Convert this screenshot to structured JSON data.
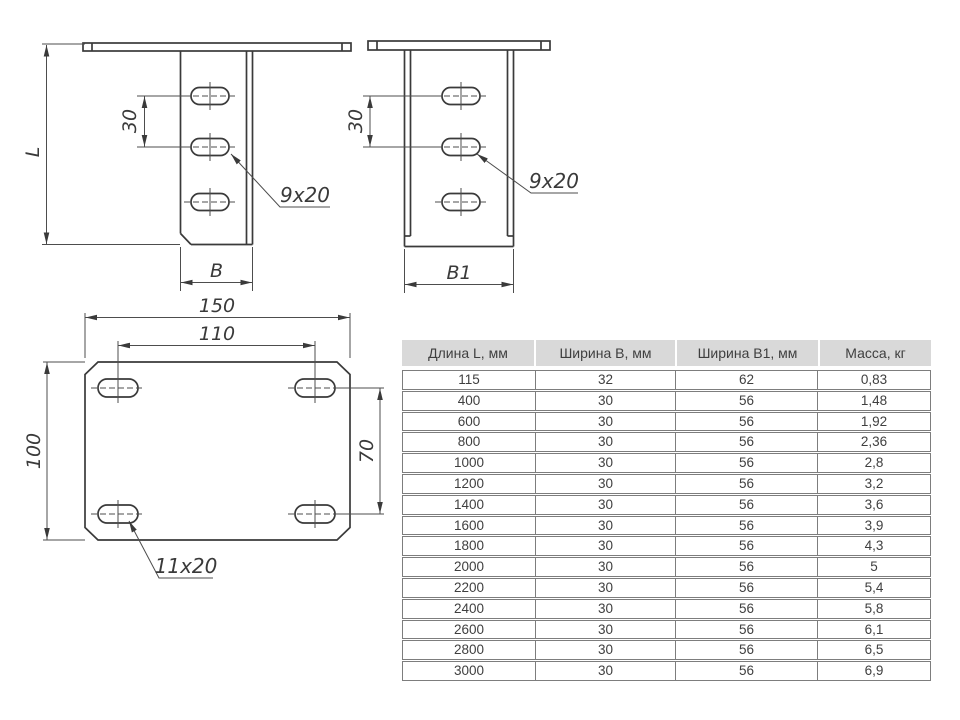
{
  "drawing": {
    "front_view": {
      "length_label": "L",
      "hole_spacing_label": "30",
      "slot_size_label": "9x20",
      "width_label": "B"
    },
    "side_view": {
      "hole_spacing_label": "30",
      "slot_size_label": "9x20",
      "width_label": "B1"
    },
    "plate_view": {
      "overall_width_label": "150",
      "hole_span_x_label": "110",
      "overall_height_label": "100",
      "hole_span_y_label": "70",
      "slot_size_label": "11x20"
    }
  },
  "table": {
    "headers": [
      "Длина L, мм",
      "Ширина B, мм",
      "Ширина B1, мм",
      "Масса, кг"
    ],
    "rows": [
      [
        "115",
        "32",
        "62",
        "0,83"
      ],
      [
        "400",
        "30",
        "56",
        "1,48"
      ],
      [
        "600",
        "30",
        "56",
        "1,92"
      ],
      [
        "800",
        "30",
        "56",
        "2,36"
      ],
      [
        "1000",
        "30",
        "56",
        "2,8"
      ],
      [
        "1200",
        "30",
        "56",
        "3,2"
      ],
      [
        "1400",
        "30",
        "56",
        "3,6"
      ],
      [
        "1600",
        "30",
        "56",
        "3,9"
      ],
      [
        "1800",
        "30",
        "56",
        "4,3"
      ],
      [
        "2000",
        "30",
        "56",
        "5"
      ],
      [
        "2200",
        "30",
        "56",
        "5,4"
      ],
      [
        "2400",
        "30",
        "56",
        "5,8"
      ],
      [
        "2600",
        "30",
        "56",
        "6,1"
      ],
      [
        "2800",
        "30",
        "56",
        "6,5"
      ],
      [
        "3000",
        "30",
        "56",
        "6,9"
      ]
    ]
  },
  "colors": {
    "line": "#3a3a3a",
    "thin_line": "#4d4d4d",
    "table_header_bg": "#d9d9d9",
    "table_border": "#7d7d7d"
  }
}
